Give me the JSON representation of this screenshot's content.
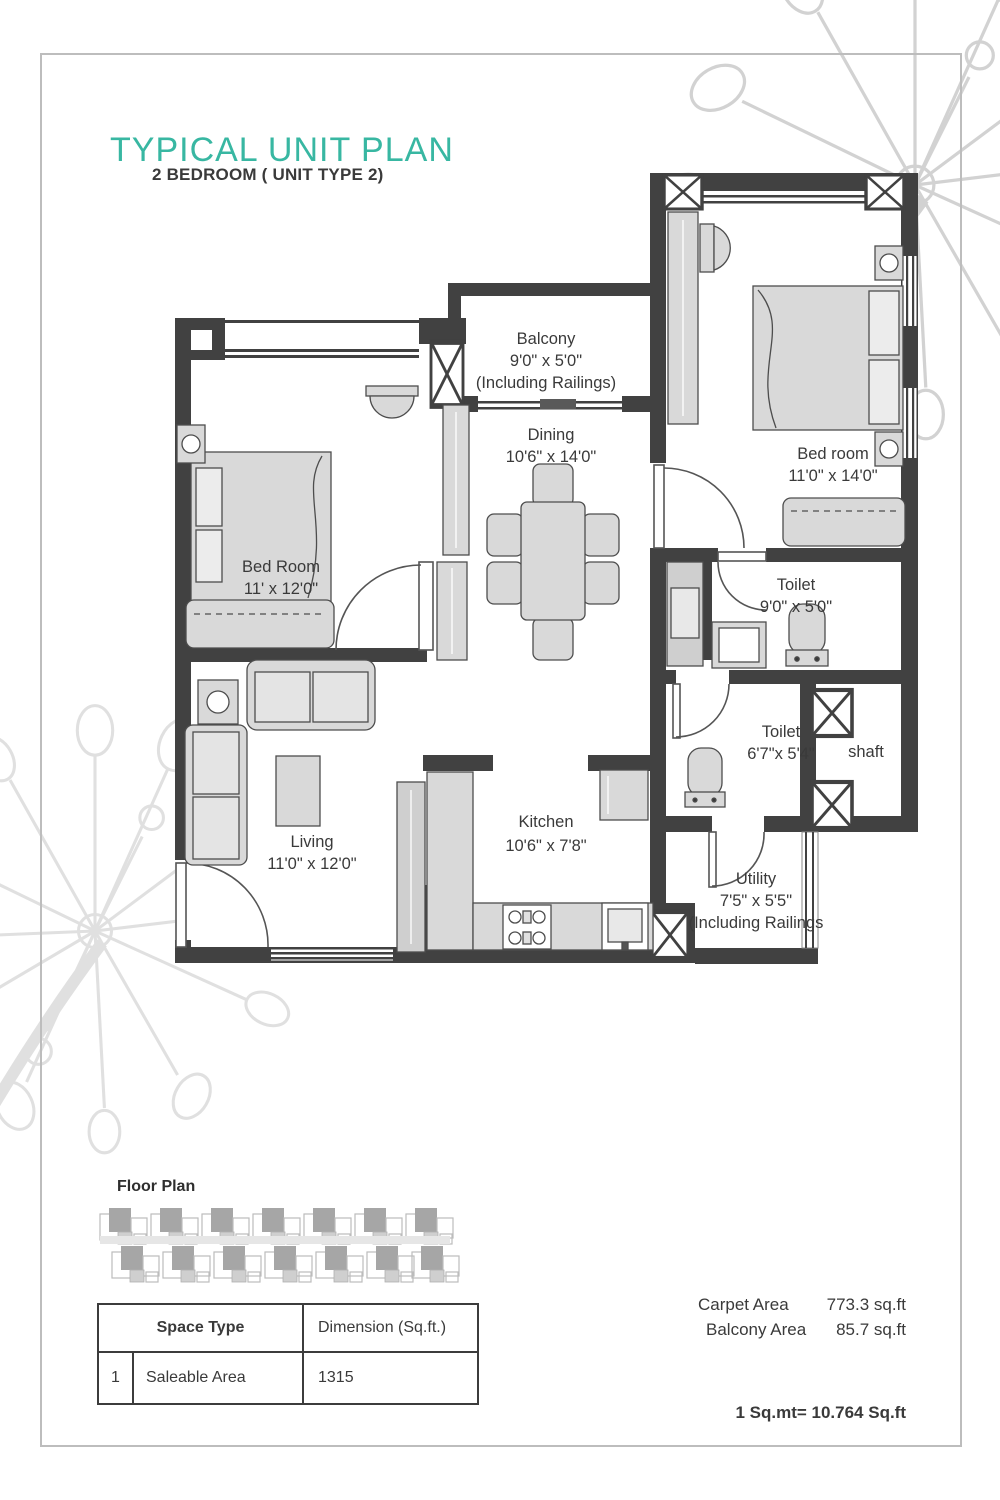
{
  "page": {
    "title": "TYPICAL UNIT PLAN",
    "subtitle": "2 BEDROOM ( UNIT TYPE 2)"
  },
  "plan": {
    "rooms": {
      "balcony": {
        "name": "Balcony",
        "dim": "9'0\" x 5'0\"",
        "note": "(Including Railings)"
      },
      "dining": {
        "name": "Dining",
        "dim": "10'6\" x 14'0\""
      },
      "bedroom_right": {
        "name": "Bed room",
        "dim": "11'0\" x 14'0\""
      },
      "bedroom_left": {
        "name": "Bed Room",
        "dim": "11' x 12'0\""
      },
      "toilet_top": {
        "name": "Toilet",
        "dim": "9'0\" x 5'0\""
      },
      "toilet_mid": {
        "name": "Toilet",
        "dim": "6'7\"x 5'4\""
      },
      "shaft": {
        "name": "shaft"
      },
      "living": {
        "name": "Living",
        "dim": "11'0\" x 12'0\""
      },
      "kitchen": {
        "name": "Kitchen",
        "dim": "10'6\" x 7'8\""
      },
      "utility": {
        "name": "Utility",
        "dim": "7'5\" x 5'5\"",
        "note": "(Including Railings"
      }
    }
  },
  "floor_plan_section": {
    "label": "Floor Plan"
  },
  "spec_table": {
    "header_space_type": "Space Type",
    "header_dimension": "Dimension (Sq.ft.)",
    "row_index": "1",
    "row_space_type": "Saleable Area",
    "row_dimension": "1315"
  },
  "areas": {
    "carpet_label": "Carpet Area",
    "carpet_value": "773.3 sq.ft",
    "balcony_label": "Balcony Area",
    "balcony_value": "85.7 sq.ft",
    "conversion": "1 Sq.mt= 10.764 Sq.ft"
  },
  "colors": {
    "accent": "#38b7a2",
    "wall": "#414141",
    "text": "#3a3a3a",
    "furniture": "#d9d9d9"
  }
}
